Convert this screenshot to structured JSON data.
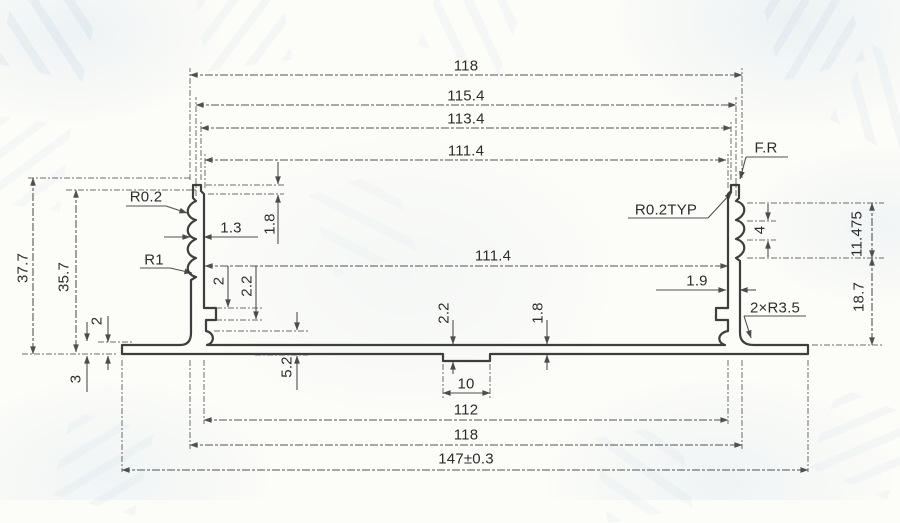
{
  "drawing": {
    "title": "aluminium extrusion profile cross-section",
    "units": "mm",
    "ink_color": "#343434",
    "paper_color": "#fcfcf8",
    "watermark_color": "#8cafd2"
  },
  "dimensions": [
    {
      "name": "top-overall-width",
      "text": "118"
    },
    {
      "name": "top-serration-width",
      "text": "115.4"
    },
    {
      "name": "top-step-width",
      "text": "113.4"
    },
    {
      "name": "top-inner-width",
      "text": "111.4"
    },
    {
      "name": "full-radius-note",
      "text": "F.R"
    },
    {
      "name": "groove-radius",
      "text": "R0.2"
    },
    {
      "name": "wall-thickness",
      "text": "1.3"
    },
    {
      "name": "top-step-height",
      "text": "1.8"
    },
    {
      "name": "groove-radius-r1",
      "text": "R1"
    },
    {
      "name": "overall-height",
      "text": "37.7"
    },
    {
      "name": "inner-height",
      "text": "35.7"
    },
    {
      "name": "cavity-inner-width",
      "text": "111.4"
    },
    {
      "name": "rib-offset",
      "text": "2"
    },
    {
      "name": "rib-height",
      "text": "2.2"
    },
    {
      "name": "flange-tip-thickness",
      "text": "2"
    },
    {
      "name": "flange-thickness",
      "text": "3"
    },
    {
      "name": "rib-bottom-height",
      "text": "5.2"
    },
    {
      "name": "boss-thickness",
      "text": "2.2"
    },
    {
      "name": "floor-thickness",
      "text": "1.8"
    },
    {
      "name": "boss-width",
      "text": "10"
    },
    {
      "name": "typical-radius-note",
      "text": "R0.2TYP"
    },
    {
      "name": "right-wall-thickness",
      "text": "1.9"
    },
    {
      "name": "serration-pitch",
      "text": "4"
    },
    {
      "name": "serration-zone-height",
      "text": "11.475"
    },
    {
      "name": "lower-wall-height",
      "text": "18.7"
    },
    {
      "name": "corner-radius-note",
      "text": "2×R3.5"
    },
    {
      "name": "bottom-inner-width",
      "text": "112"
    },
    {
      "name": "bottom-outer-width",
      "text": "118"
    },
    {
      "name": "overall-flange-width",
      "text": "147±0.3"
    }
  ]
}
